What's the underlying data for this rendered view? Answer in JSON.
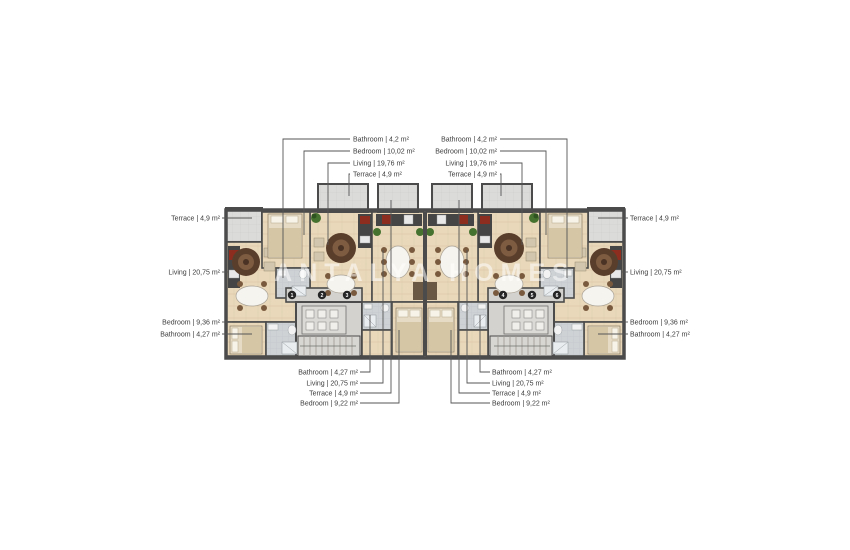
{
  "watermark": {
    "text": "ANTALYA HOMES"
  },
  "doors": [
    "1",
    "2",
    "3",
    "4",
    "5",
    "6"
  ],
  "callouts": {
    "top_left": [
      "Bathroom | 4,2 m²",
      "Bedroom | 10,02 m²",
      "Living | 19,76 m²",
      "Terrace | 4,9 m²"
    ],
    "top_right": [
      "Bathroom | 4,2 m²",
      "Bedroom | 10,02 m²",
      "Living | 19,76 m²",
      "Terrace | 4,9 m²"
    ],
    "left": [
      "Terrace | 4,9 m²",
      "Living | 20,75 m²",
      "Bedroom | 9,36 m²",
      "Bathroom | 4,27 m²"
    ],
    "right": [
      "Terrace | 4,9 m²",
      "Living | 20,75 m²",
      "Bedroom | 9,36 m²",
      "Bathroom | 4,27 m²"
    ],
    "bottom_left": [
      "Bathroom | 4,27 m²",
      "Living | 20,75 m²",
      "Terrace | 4,9 m²",
      "Bedroom | 9,22 m²"
    ],
    "bottom_right": [
      "Bathroom | 4,27 m²",
      "Living | 20,75 m²",
      "Terrace | 4,9 m²",
      "Bedroom | 9,22 m²"
    ]
  },
  "colors": {
    "wall": "#4b4b4b",
    "wood_floor": "#e9d8ba",
    "terrace_floor": "#dbdbd9",
    "bath_floor": "#ced2d5",
    "accent_red": "#8c2d1f",
    "rug_brown": "#5a3e2c",
    "plant_green": "#46722f",
    "leader_line": "#555555"
  }
}
